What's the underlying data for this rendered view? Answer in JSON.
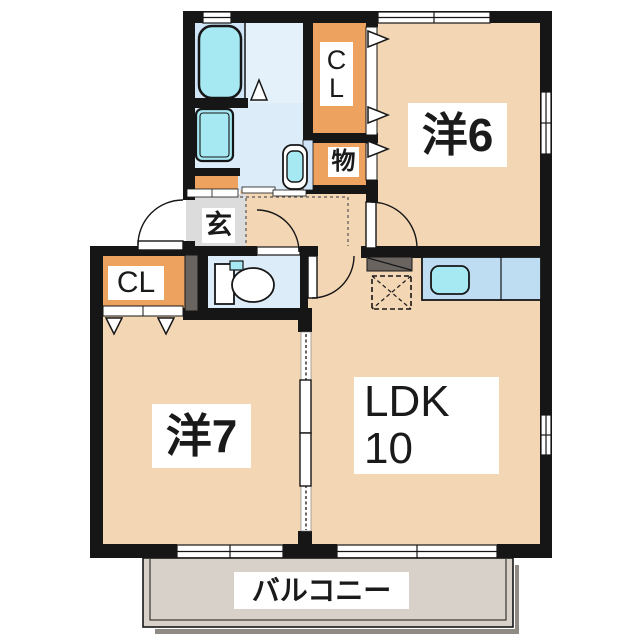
{
  "title": "apartment-floorplan",
  "rooms": {
    "western6": {
      "label": "洋6"
    },
    "western7": {
      "label": "洋7"
    },
    "ldk": {
      "label": "LDK",
      "size": "10"
    },
    "balcony": {
      "label": "バルコニー"
    },
    "entrance": {
      "label": "玄"
    },
    "storage": {
      "label": "物"
    },
    "closet_north": {
      "line1": "C",
      "line2": "L"
    },
    "closet_west": {
      "label": "CL"
    }
  },
  "colors": {
    "wall": "#161616",
    "room_peach": "#f3d6b4",
    "closet_orange": "#eda25f",
    "wet_blue": "#dcecf9",
    "bath_blue": "#cfe4f6",
    "bath_blue_light": "#e4f1fb",
    "fixture_cyan": "#a6e9f2",
    "counter_blue": "#bedcf2",
    "genkan_grey": "#dcdcdc",
    "balcony_grey": "#d8d1ca",
    "slab_grey": "#6a6460",
    "shadow_grey": "#8f8a84"
  }
}
